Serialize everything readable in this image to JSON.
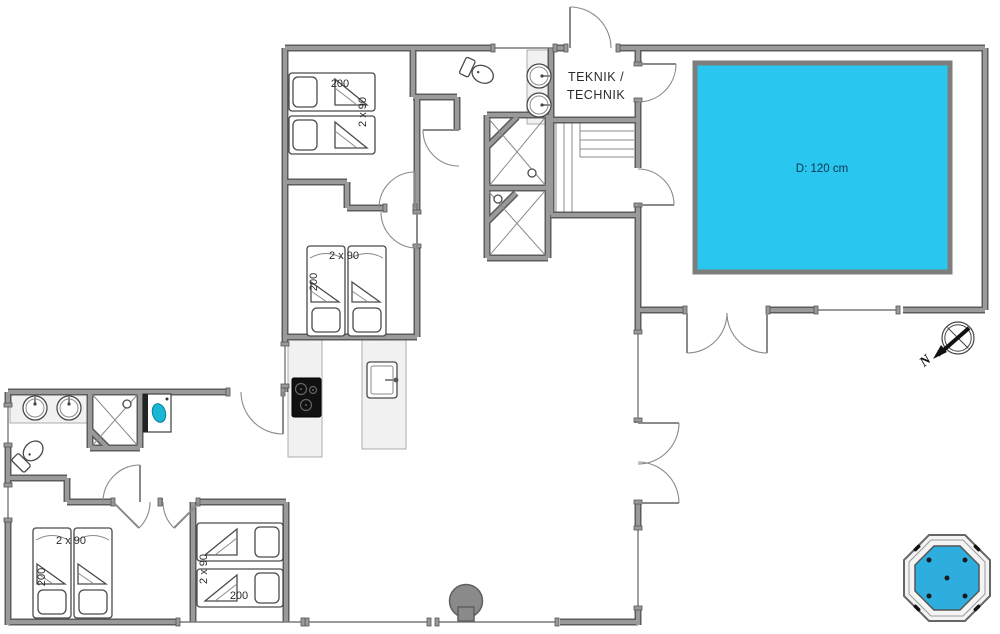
{
  "plan": {
    "colors": {
      "pool": "#29c6f0",
      "pool_label": "#0d3550",
      "tub": "#2eaede",
      "washer": "#19b7d6"
    },
    "pool": {
      "depth_label": "D: 120 cm"
    },
    "technical_room": {
      "line1": "TEKNIK /",
      "line2": "TECHNIK"
    },
    "compass": {
      "north_label": "N"
    },
    "bedrooms": {
      "top_left": {
        "bed_length": "200",
        "bed_size": "2 x 90"
      },
      "middle": {
        "bed_size": "2 x 90",
        "bed_length": "200"
      },
      "bottom_left": {
        "bed_size": "2 x 90",
        "bed_length": "200"
      },
      "bottom_middle": {
        "bed_size": "2 x 90",
        "bed_length": "200"
      }
    }
  }
}
